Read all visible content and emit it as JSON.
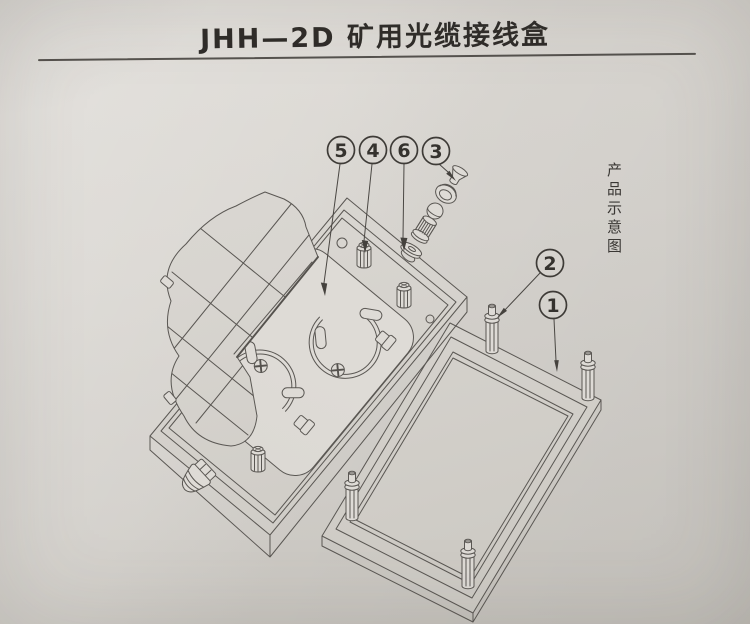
{
  "page": {
    "title": "JHH—2D 矿用光缆接线盒",
    "side_caption": "产品示意图"
  },
  "callouts": {
    "items": [
      {
        "label": "5"
      },
      {
        "label": "4"
      },
      {
        "label": "6"
      },
      {
        "label": "3"
      },
      {
        "label": "2"
      },
      {
        "label": "1"
      }
    ]
  },
  "colors": {
    "paper": "#d8d5d0",
    "line": "#5a5753",
    "ink": "#2f2c29"
  }
}
